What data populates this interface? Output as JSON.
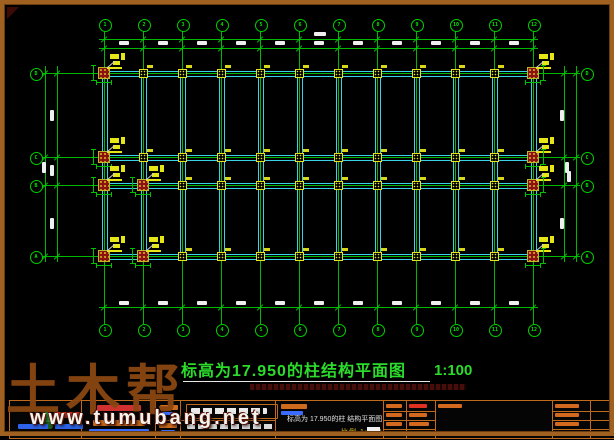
{
  "plan": {
    "title": "标高为17.950的柱结构平面图",
    "title_scale": "1:100",
    "axes_top": [
      "1",
      "2",
      "3",
      "4",
      "5",
      "6",
      "7",
      "8",
      "9",
      "10",
      "11",
      "12"
    ],
    "axes_bottom": [
      "1",
      "2",
      "3",
      "4",
      "5",
      "6",
      "7",
      "8",
      "9",
      "10",
      "11",
      "12"
    ],
    "axes_left": [
      "D",
      "C",
      "B",
      "A"
    ],
    "axes_right": [
      "D",
      "C",
      "B",
      "A"
    ],
    "colors": {
      "grid": "#00b800",
      "beam": "#39d2e8",
      "column_fill": "#8d1111",
      "marker": "#e4e41c",
      "dimension_text": "#efefef",
      "title_text": "#2bdc2b"
    }
  },
  "watermark": {
    "brand": "土木帮",
    "site": "www.tumubang.net"
  },
  "title_block": {
    "drawing_name": "标高为 17.950的柱 结构平面图",
    "scale_text": "比例 1:100"
  }
}
